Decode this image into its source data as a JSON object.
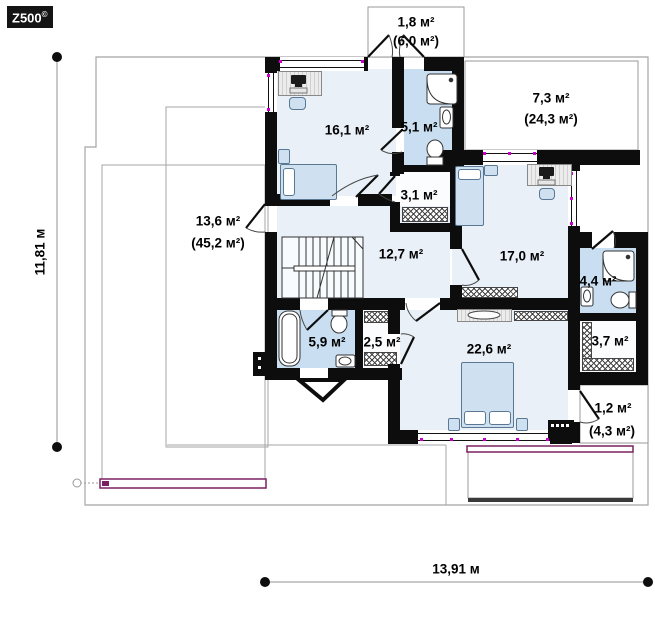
{
  "logo": {
    "text": "Z500",
    "mark": "©"
  },
  "dimensions": {
    "height_label": "11,81 м",
    "width_label": "13,91 м"
  },
  "palette": {
    "wall": "#0d0d0d",
    "room_fill": "#e9f0f8",
    "bath_fill": "#c9def0",
    "window_marker": "#cc00cc",
    "railing": "#7a2060",
    "outline": "#a5a5a5"
  },
  "rooms": [
    {
      "id": "balcony-top",
      "area": "1,8 м²",
      "total": "(6,0 м²)"
    },
    {
      "id": "terrace-right",
      "area": "7,3 м²",
      "total": "(24,3 м²)"
    },
    {
      "id": "bedroom-1",
      "area": "16,1 м²"
    },
    {
      "id": "bathroom-1",
      "area": "5,1 м²"
    },
    {
      "id": "closet-1",
      "area": "3,1 м²"
    },
    {
      "id": "terrace-left",
      "area": "13,6 м²",
      "total": "(45,2 м²)"
    },
    {
      "id": "hall",
      "area": "12,7 м²"
    },
    {
      "id": "bedroom-2",
      "area": "17,0 м²"
    },
    {
      "id": "bathroom-2",
      "area": "4,4 м²"
    },
    {
      "id": "bathroom-3",
      "area": "5,9 м²"
    },
    {
      "id": "wardrobe-1",
      "area": "2,5 м²"
    },
    {
      "id": "bedroom-3",
      "area": "22,6 м²"
    },
    {
      "id": "wardrobe-2",
      "area": "3,7 м²"
    },
    {
      "id": "balcony-right",
      "area": "1,2 м²",
      "total": "(4,3 м²)"
    }
  ]
}
